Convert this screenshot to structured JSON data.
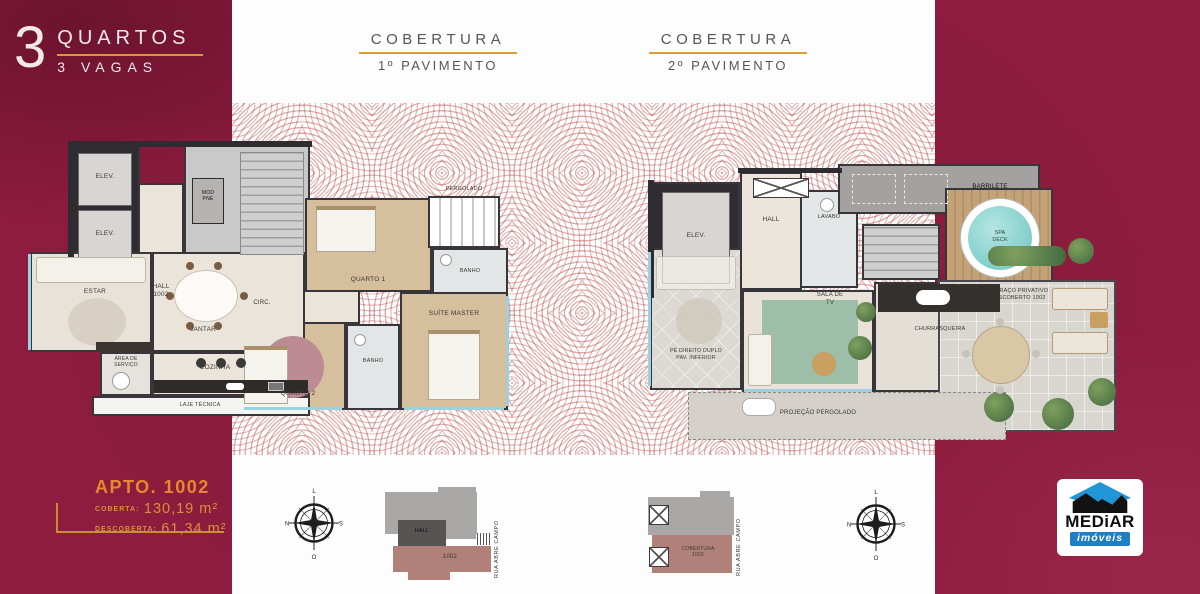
{
  "headline": {
    "number": "3",
    "line1": "QUARTOS",
    "line2": "3 VAGAS"
  },
  "headers": [
    {
      "title": "COBERTURA",
      "subtitle": "1º PAVIMENTO"
    },
    {
      "title": "COBERTURA",
      "subtitle": "2º PAVIMENTO"
    }
  ],
  "plan1": {
    "elev1": "ELEV.",
    "elev2": "ELEV.",
    "hall": "HALL\n1002",
    "mod": "MOD\nPNE",
    "pergolado": "PERGOLADO",
    "quarto1": "QUARTO 1",
    "banho1": "BANHO",
    "circ": "CIRC.",
    "estar": "ESTAR",
    "jantar": "JANTAR",
    "cozinha": "COZINHA",
    "servico": "ÁREA DE\nSERVIÇO",
    "laje": "LAJE TÉCNICA",
    "quarto2": "QUARTO 2",
    "banho2": "BANHO",
    "suite": "SUÍTE MASTER"
  },
  "plan2": {
    "elev": "ELEV.",
    "hall": "HALL",
    "lavabo": "LAVABO",
    "barrilete": "BARRILETE",
    "pedireito": "PÉ DIREITO DUPLO\nPAV. INFERIOR",
    "sala": "SALA DE\nTV",
    "churrasqueira": "CHURRASQUEIRA",
    "spa": "SPA\nDECK",
    "terraco": "TERRAÇO PRIVATIVO\nDESCOBERTO 1002",
    "projecao": "PROJEÇÃO PERGOLADO"
  },
  "info": {
    "apto_title": "APTO. 1002",
    "row1_label": "COBERTA:",
    "row1_value": "130,19 m²",
    "row2_label": "DESCOBERTA:",
    "row2_value": "61,34 m²"
  },
  "compass": {
    "top": "L",
    "right": "S",
    "bottom": "O",
    "left": "N"
  },
  "siteplan1": {
    "hall": "HALL",
    "unit": "1002",
    "street": "RUA ABRE CAMPO"
  },
  "siteplan2": {
    "unit": "COBERTURA\n1002",
    "street": "RUA ABRE CAMPO"
  },
  "logo": {
    "name": "MEDiAR",
    "tagline": "imóveis"
  },
  "colors": {
    "background_maroon": "#8d1c3e",
    "accent_gold": "#d9992e",
    "accent_orange": "#e8872e",
    "pattern_red": "#c15858",
    "logo_blue": "#1e7fc4",
    "wall_dark": "#2e2c31",
    "spa_teal": "#7fd0cc",
    "siteplan_rose": "#b18179"
  }
}
